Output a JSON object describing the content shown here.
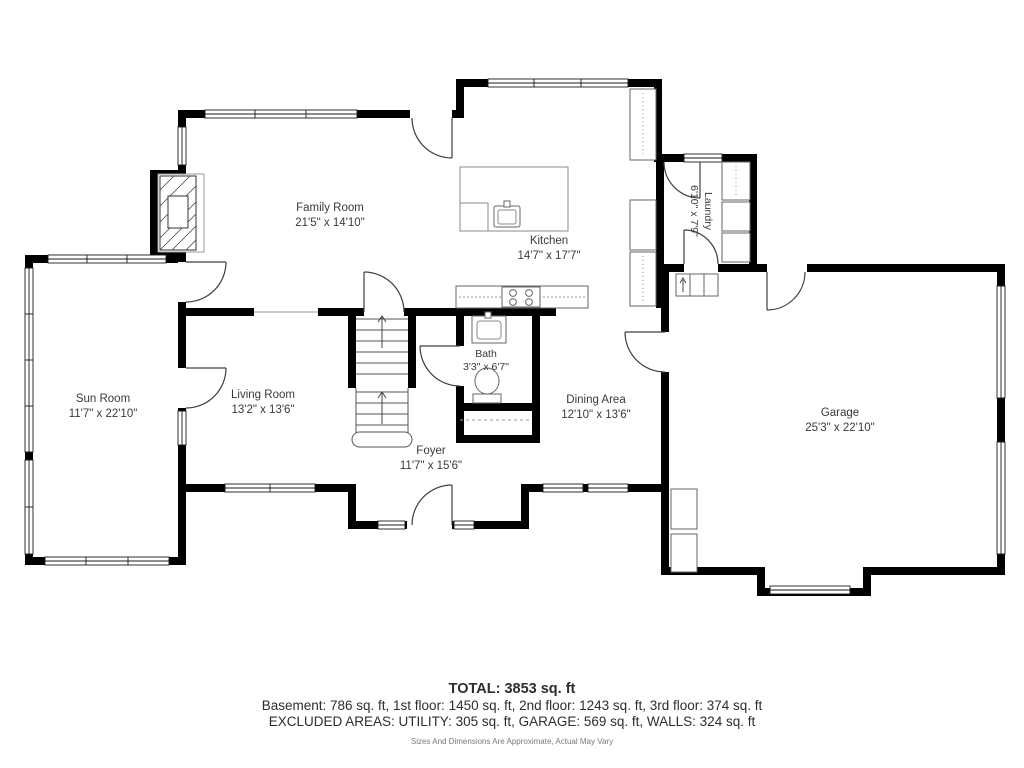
{
  "plan": {
    "rooms": {
      "family": {
        "label": "Family Room",
        "dims": "21'5\" x 14'10\""
      },
      "kitchen": {
        "label": "Kitchen",
        "dims": "14'7\" x 17'7\""
      },
      "laundry": {
        "label": "Laundry",
        "dims": "6'10\" x 7'9\""
      },
      "sun": {
        "label": "Sun Room",
        "dims": "11'7\" x 22'10\""
      },
      "living": {
        "label": "Living Room",
        "dims": "13'2\" x 13'6\""
      },
      "bath": {
        "label": "Bath",
        "dims": "3'3\" x 6'7\""
      },
      "dining": {
        "label": "Dining Area",
        "dims": "12'10\" x 13'6\""
      },
      "foyer": {
        "label": "Foyer",
        "dims": "11'7\" x 15'6\""
      },
      "garage": {
        "label": "Garage",
        "dims": "25'3\" x 22'10\""
      }
    },
    "colors": {
      "wall": "#000000",
      "text": "#3a3a3a"
    }
  },
  "footer": {
    "total": "TOTAL: 3853 sq. ft",
    "floors": "Basement: 786 sq. ft, 1st floor: 1450 sq. ft, 2nd floor: 1243 sq. ft, 3rd floor: 374 sq. ft",
    "excluded": "EXCLUDED AREAS: UTILITY: 305 sq. ft, GARAGE: 569 sq. ft, WALLS: 324 sq. ft",
    "disclaimer": "Sizes And Dimensions Are Approximate, Actual May Vary"
  }
}
